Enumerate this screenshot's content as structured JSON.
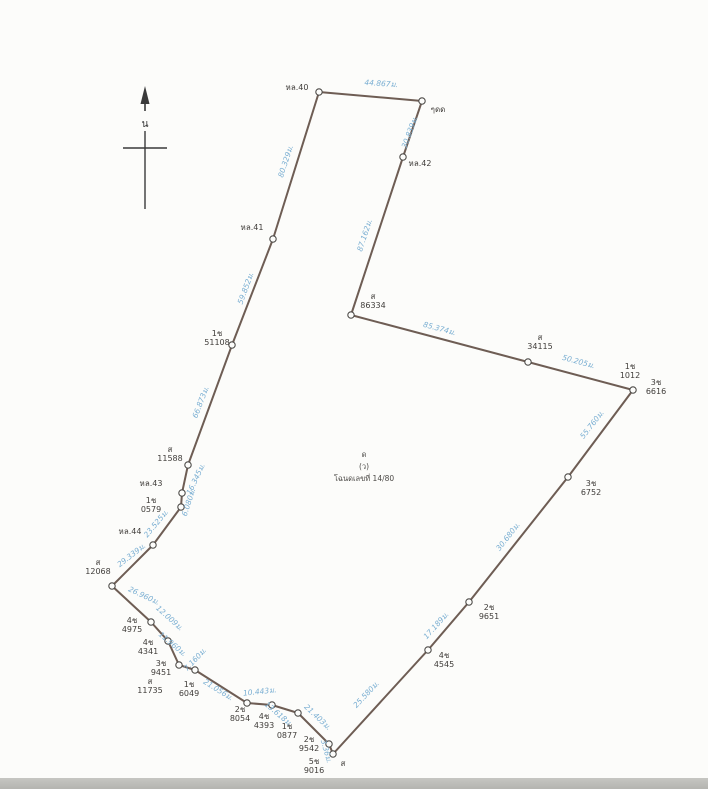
{
  "colors": {
    "edge": "#6e5d54",
    "vertex_fill": "#fdfdfb",
    "vertex_stroke": "#4f4d4a",
    "distance_text": "#79aed2",
    "marker_text": "#403d3a",
    "paper": "#fcfcfa",
    "bottom_strip": "#bcbcb8"
  },
  "north": {
    "label": "น"
  },
  "parcel_center": {
    "x": 364,
    "y": 457,
    "lines": [
      "ด",
      "(ว)",
      "โฉนดเลขที่ 14/80"
    ]
  },
  "boundary_points": [
    {
      "x": 319,
      "y": 92
    },
    {
      "x": 422,
      "y": 101
    },
    {
      "x": 403,
      "y": 157
    },
    {
      "x": 351,
      "y": 315
    },
    {
      "x": 528,
      "y": 362
    },
    {
      "x": 633,
      "y": 390
    },
    {
      "x": 568,
      "y": 477
    },
    {
      "x": 469,
      "y": 602
    },
    {
      "x": 428,
      "y": 650
    },
    {
      "x": 333,
      "y": 754
    },
    {
      "x": 329,
      "y": 744
    },
    {
      "x": 298,
      "y": 713
    },
    {
      "x": 272,
      "y": 705
    },
    {
      "x": 247,
      "y": 703
    },
    {
      "x": 195,
      "y": 670
    },
    {
      "x": 179,
      "y": 665
    },
    {
      "x": 168,
      "y": 641
    },
    {
      "x": 151,
      "y": 622
    },
    {
      "x": 112,
      "y": 586
    },
    {
      "x": 153,
      "y": 545
    },
    {
      "x": 181,
      "y": 507
    },
    {
      "x": 182,
      "y": 493
    },
    {
      "x": 188,
      "y": 465
    },
    {
      "x": 232,
      "y": 345
    },
    {
      "x": 273,
      "y": 239
    }
  ],
  "distance_labels": [
    {
      "text": "44.867ม.",
      "x": 381,
      "y": 86,
      "angle": 4
    },
    {
      "text": "30.839ม.",
      "x": 412,
      "y": 133,
      "angle": -70
    },
    {
      "text": "87.162ม.",
      "x": 367,
      "y": 236,
      "angle": -72
    },
    {
      "text": "85.374ม.",
      "x": 439,
      "y": 331,
      "angle": 15
    },
    {
      "text": "50.205ม.",
      "x": 578,
      "y": 364,
      "angle": 15
    },
    {
      "text": "55.760ม.",
      "x": 594,
      "y": 426,
      "angle": -52
    },
    {
      "text": "30.680ม.",
      "x": 510,
      "y": 538,
      "angle": -52
    },
    {
      "text": "17.189ม.",
      "x": 438,
      "y": 627,
      "angle": -48
    },
    {
      "text": "25.580ม.",
      "x": 368,
      "y": 696,
      "angle": -47
    },
    {
      "text": "3.36ม.",
      "x": 324,
      "y": 752,
      "angle": 74
    },
    {
      "text": "21.403ม.",
      "x": 316,
      "y": 719,
      "angle": 43
    },
    {
      "text": "13.618ม.",
      "x": 277,
      "y": 716,
      "angle": 40
    },
    {
      "text": "10.443ม.",
      "x": 260,
      "y": 694,
      "angle": -6
    },
    {
      "text": "21.056ม.",
      "x": 217,
      "y": 692,
      "angle": 32
    },
    {
      "text": "7.160ม.",
      "x": 197,
      "y": 661,
      "angle": -47
    },
    {
      "text": "11.960ม.",
      "x": 171,
      "y": 646,
      "angle": 40
    },
    {
      "text": "12.009ม.",
      "x": 168,
      "y": 620,
      "angle": 42
    },
    {
      "text": "26.960ม.",
      "x": 143,
      "y": 598,
      "angle": 25
    },
    {
      "text": "29.339ม.",
      "x": 133,
      "y": 557,
      "angle": -38
    },
    {
      "text": "23.525ม.",
      "x": 158,
      "y": 525,
      "angle": -50
    },
    {
      "text": "6.080ม.",
      "x": 191,
      "y": 503,
      "angle": -72
    },
    {
      "text": "16.345ม.",
      "x": 198,
      "y": 480,
      "angle": -65
    },
    {
      "text": "66.873ม.",
      "x": 203,
      "y": 403,
      "angle": -69
    },
    {
      "text": "59.852ม.",
      "x": 248,
      "y": 289,
      "angle": -70
    },
    {
      "text": "80.329ม.",
      "x": 288,
      "y": 162,
      "angle": -72
    }
  ],
  "marker_labels": [
    {
      "x": 297,
      "y": 90,
      "lines": [
        "หล.40"
      ]
    },
    {
      "x": 438,
      "y": 112,
      "lines": [
        "ๆดด"
      ]
    },
    {
      "x": 420,
      "y": 166,
      "lines": [
        "หล.42"
      ]
    },
    {
      "x": 373,
      "y": 299,
      "lines": [
        "ส",
        "86334"
      ]
    },
    {
      "x": 540,
      "y": 340,
      "lines": [
        "ส",
        "34115"
      ]
    },
    {
      "x": 630,
      "y": 369,
      "lines": [
        "1ช",
        "1012"
      ]
    },
    {
      "x": 656,
      "y": 385,
      "lines": [
        "3ช",
        "6616"
      ]
    },
    {
      "x": 591,
      "y": 486,
      "lines": [
        "3ช",
        "6752"
      ]
    },
    {
      "x": 489,
      "y": 610,
      "lines": [
        "2ช",
        "9651"
      ]
    },
    {
      "x": 444,
      "y": 658,
      "lines": [
        "4ช",
        "4545"
      ]
    },
    {
      "x": 309,
      "y": 742,
      "lines": [
        "2ช",
        "9542"
      ]
    },
    {
      "x": 314,
      "y": 764,
      "lines": [
        "5ช",
        "9016"
      ]
    },
    {
      "x": 343,
      "y": 766,
      "lines": [
        "ส"
      ]
    },
    {
      "x": 287,
      "y": 729,
      "lines": [
        "1ช",
        "0877"
      ]
    },
    {
      "x": 264,
      "y": 719,
      "lines": [
        "4ช",
        "4393"
      ]
    },
    {
      "x": 240,
      "y": 712,
      "lines": [
        "2ช",
        "8054"
      ]
    },
    {
      "x": 189,
      "y": 687,
      "lines": [
        "1ช",
        "6049"
      ]
    },
    {
      "x": 150,
      "y": 684,
      "lines": [
        "ส",
        "11735"
      ]
    },
    {
      "x": 161,
      "y": 666,
      "lines": [
        "3ช",
        "9451"
      ]
    },
    {
      "x": 148,
      "y": 645,
      "lines": [
        "4ช",
        "4341"
      ]
    },
    {
      "x": 132,
      "y": 623,
      "lines": [
        "4ช",
        "4975"
      ]
    },
    {
      "x": 98,
      "y": 565,
      "lines": [
        "ส",
        "12068"
      ]
    },
    {
      "x": 130,
      "y": 534,
      "lines": [
        "หล.44"
      ]
    },
    {
      "x": 151,
      "y": 503,
      "lines": [
        "1ช",
        "0579"
      ]
    },
    {
      "x": 151,
      "y": 486,
      "lines": [
        "หล.43"
      ]
    },
    {
      "x": 170,
      "y": 452,
      "lines": [
        "ส",
        "11588"
      ]
    },
    {
      "x": 217,
      "y": 336,
      "lines": [
        "1ช",
        "51108"
      ]
    },
    {
      "x": 252,
      "y": 230,
      "lines": [
        "หล.41"
      ]
    }
  ]
}
